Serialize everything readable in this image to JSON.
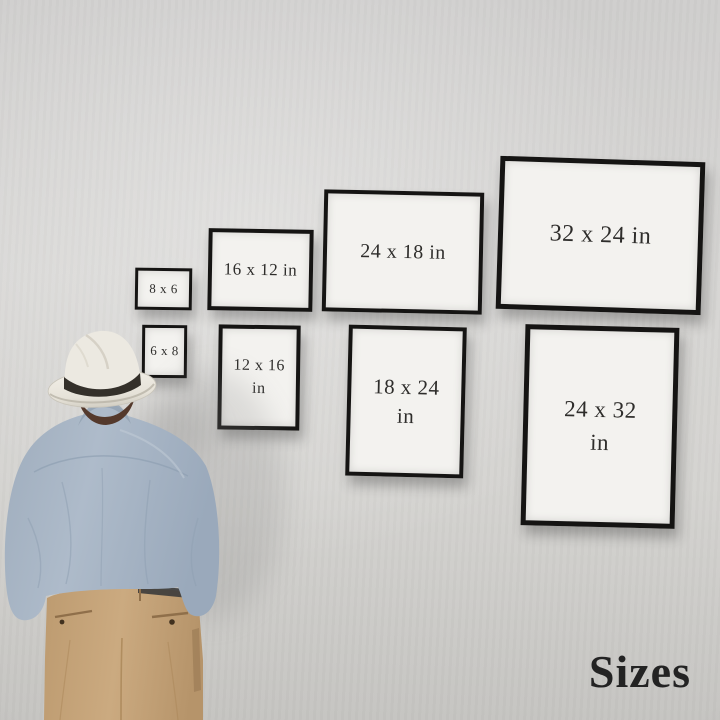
{
  "frames": [
    {
      "id": "8x6",
      "label": "8 x 6",
      "orientation": "landscape"
    },
    {
      "id": "16x12",
      "label": "16 x 12 in",
      "orientation": "landscape"
    },
    {
      "id": "24x18",
      "label": "24 x 18 in",
      "orientation": "landscape"
    },
    {
      "id": "32x24",
      "label": "32 x 24 in",
      "orientation": "landscape"
    },
    {
      "id": "6x8",
      "label": "6 x 8",
      "orientation": "portrait"
    },
    {
      "id": "12x16",
      "label": "12 x 16\nin",
      "orientation": "portrait"
    },
    {
      "id": "18x24",
      "label": "18 x 24\nin",
      "orientation": "portrait"
    },
    {
      "id": "24x32",
      "label": "24 x 32\nin",
      "orientation": "portrait"
    }
  ],
  "caption": {
    "text": "Sizes"
  },
  "figure": {
    "name": "man-in-hat-viewed-from-behind"
  },
  "colors": {
    "wall": "#d3d2d0",
    "frame_border": "#151413",
    "frame_paper": "#f3f2ef",
    "label_text": "#2e2d2b",
    "caption_text": "#232323",
    "hat": "#ebe8e0",
    "hat_band": "#34302a",
    "hair": "#54392c",
    "shirt": "#a9b6c5",
    "shirt_shade": "#8fa0b2",
    "pants": "#c7a67c",
    "pants_shade": "#a98657",
    "belt": "#3b3b3b"
  }
}
